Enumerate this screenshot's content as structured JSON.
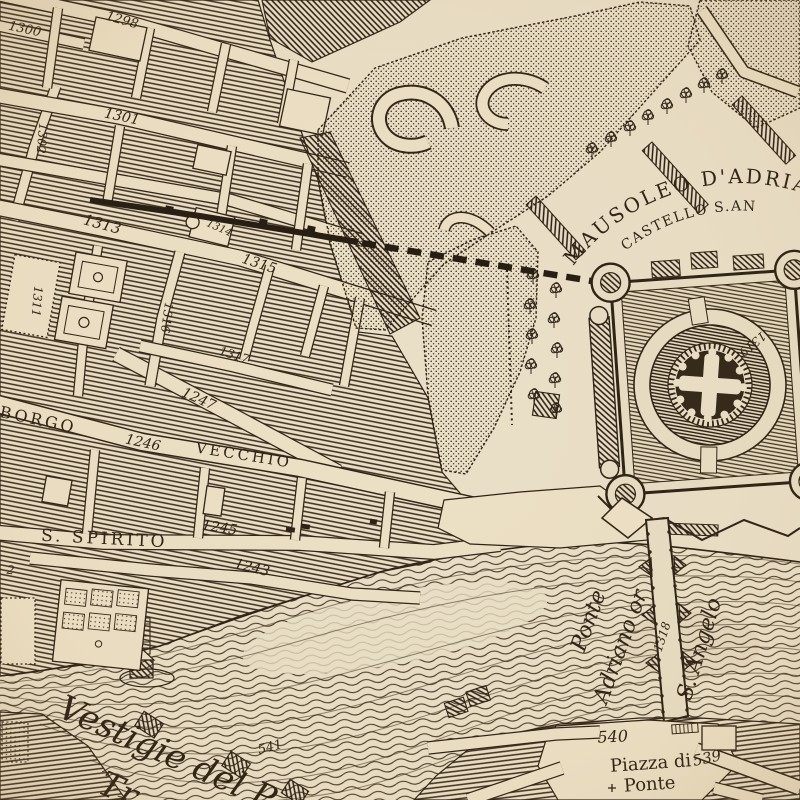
{
  "map": {
    "type": "antique engraved city map (Rome, Borgo / Castel Sant'Angelo area)",
    "colors": {
      "parchment": "#e9dec6",
      "street": "#ebdfc4",
      "ink": "#2b2014"
    },
    "labels": {
      "n1298": "1298",
      "n1300": "1300",
      "n1301": "1301",
      "n1302": "1302",
      "n1311": "1311",
      "n1313": "1313",
      "n1314": "1314",
      "n1315": "1315",
      "n1316": "1316",
      "n1317": "1317",
      "n1243": "1243",
      "n1245": "1245",
      "n1246": "1246",
      "n1247": "1247",
      "n1318": "1318",
      "n1319": "1319",
      "n2": "2",
      "n539": "539",
      "n540": "540",
      "n541": "541",
      "borgo": "BORGO",
      "vecchio": "VECCHIO",
      "s_spirito": "S. SPIRITO",
      "mausoleo": "MAUSOLEO D'ADRIA",
      "castello": "CASTELLO S.AN",
      "ponte_bridge": "Ponte",
      "adriano_or": "Adriano or",
      "s_angelo": "S. Angelo",
      "piazza_di": "Piazza di",
      "piazza_ponte": "Ponte",
      "vestigie_line1": "Vestigie del P",
      "vestigie_line2": "Tr"
    }
  }
}
